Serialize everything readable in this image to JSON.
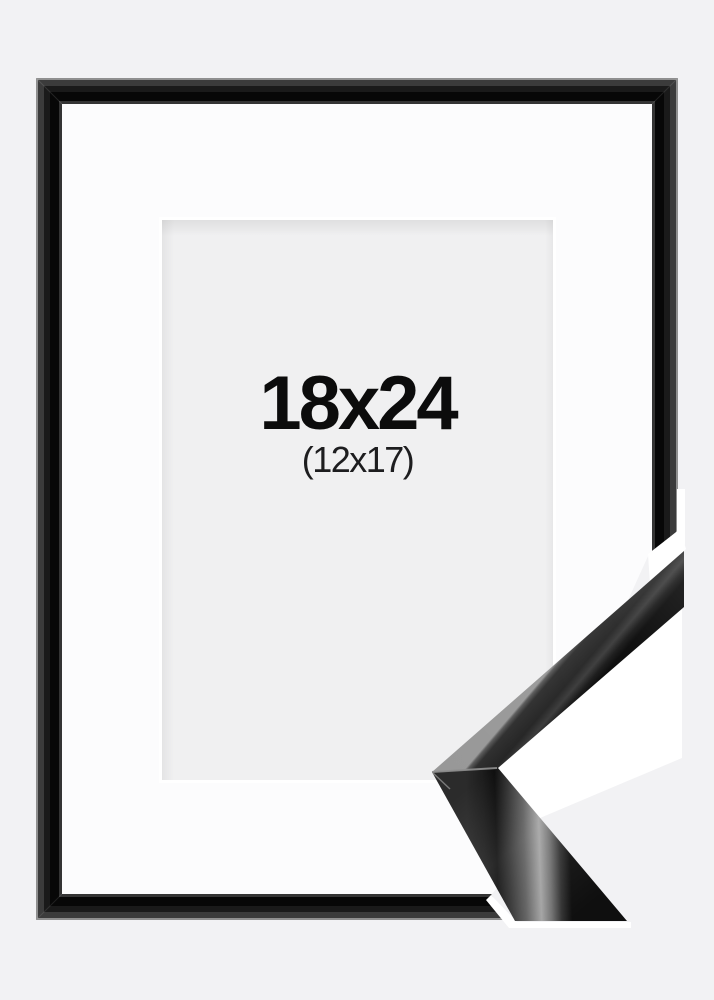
{
  "product_image": {
    "frame_size_label": "18x24",
    "mat_opening_label": "(12x17)"
  },
  "colors": {
    "background": "#f2f2f4",
    "frame_glossy_black": "#070707",
    "frame_slope_gray": "#3b3b3b",
    "frame_outer_highlight": "#8f8f8f",
    "frame_inner_lip": "#343434",
    "mat_white": "#fcfcfd",
    "opening_gray": "#f0f0f1",
    "backdrop_white": "#ffffff",
    "text_primary": "#0c0c0c",
    "text_secondary": "#1d1d1f"
  }
}
